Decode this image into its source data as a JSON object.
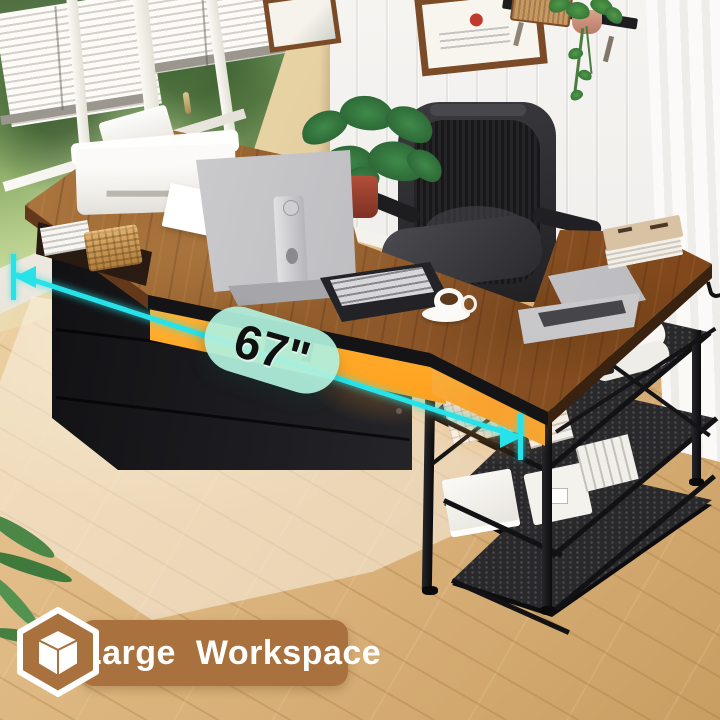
{
  "annotations": {
    "measurement": {
      "label": "67\"",
      "line_color": "#27e3e9",
      "pill_bg": "#b0f0de",
      "label_color": "#101010"
    },
    "feature_banner": {
      "label": "Large Workspace",
      "icon": "cube-3d-icon",
      "bg_color": "#a8713e",
      "label_color": "#ffffff"
    }
  },
  "scene_colors": {
    "desk_wood": "#8a5427",
    "led_glow": "#ffa21f",
    "metal_frame": "#141416",
    "floor": "#ddb77f",
    "left_wall": "#e3cb9a",
    "right_wall": "#f0eeea"
  }
}
